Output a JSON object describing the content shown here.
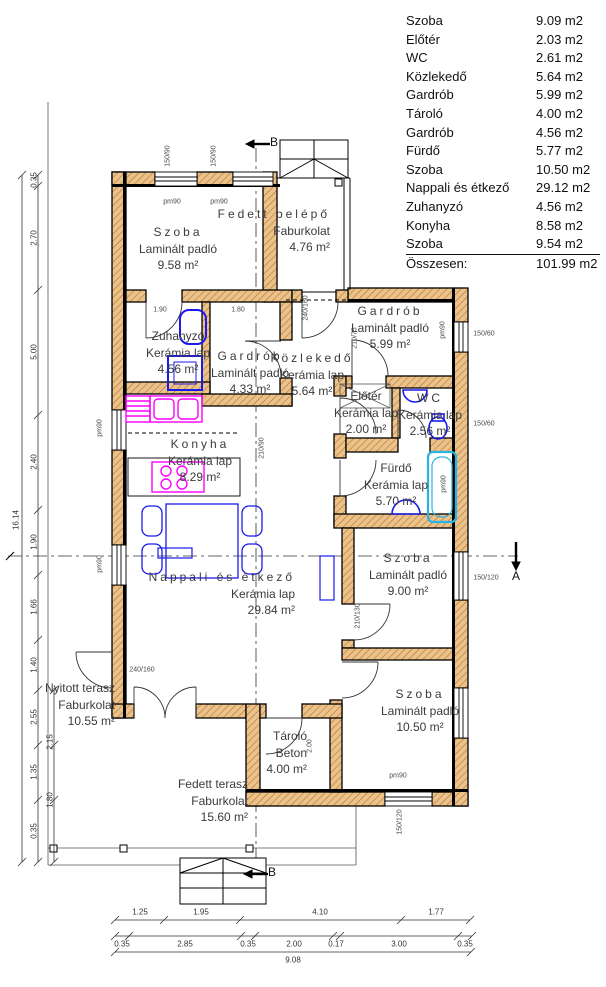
{
  "legend": {
    "rows": [
      {
        "name": "Szoba",
        "area": "9.09 m2"
      },
      {
        "name": "Előtér",
        "area": "2.03 m2"
      },
      {
        "name": "WC",
        "area": "2.61 m2"
      },
      {
        "name": "Közlekedő",
        "area": "5.64 m2"
      },
      {
        "name": "Gardrób",
        "area": "5.99 m2"
      },
      {
        "name": "Tároló",
        "area": "4.00 m2"
      },
      {
        "name": "Gardrób",
        "area": "4.56 m2"
      },
      {
        "name": "Fürdő",
        "area": "5.77 m2"
      },
      {
        "name": "Szoba",
        "area": "10.50 m2"
      },
      {
        "name": "Nappali és étkező",
        "area": "29.12 m2"
      },
      {
        "name": "Zuhanyzó",
        "area": "4.56 m2"
      },
      {
        "name": "Konyha",
        "area": "8.58 m2"
      },
      {
        "name": "Szoba",
        "area": "9.54 m2"
      }
    ],
    "total_label": "Összesen:",
    "total_value": "101.99 m2"
  },
  "rooms": {
    "szoba1": {
      "name": "Szoba",
      "floor": "Laminált padló",
      "area": "9.58 m²"
    },
    "fedett_belepo": {
      "name": "Fedett belépő",
      "floor": "Faburkolat",
      "area": "4.76 m²"
    },
    "zuhanyzo": {
      "name": "Zuhanyzó",
      "floor": "Kerámia lap",
      "area": "4.56 m²"
    },
    "gardrob1": {
      "name": "Gardrób",
      "floor": "Laminált padló",
      "area": "4.33 m²"
    },
    "kozlekedo": {
      "name": "Közlekedő",
      "floor": "Kerámia lap",
      "area": "5.64 m²"
    },
    "gardrob2": {
      "name": "Gardrób",
      "floor": "Laminált padló",
      "area": "5.99 m²"
    },
    "eloter": {
      "name": "Előtér",
      "floor": "Kerámia lap",
      "area": "2.00 m²"
    },
    "wc": {
      "name": "WC",
      "floor": "Kerámia lap",
      "area": "2.56 m²"
    },
    "konyha": {
      "name": "Konyha",
      "floor": "Kerámia lap",
      "area": "8.29 m²"
    },
    "furdo": {
      "name": "Fürdő",
      "floor": "Kerámia lap",
      "area": "5.70 m²"
    },
    "szoba2": {
      "name": "Szoba",
      "floor": "Laminált padló",
      "area": "9.00 m²"
    },
    "nappali": {
      "name": "Nappali és étkező",
      "floor": "Kerámia lap",
      "area": "29.84 m²"
    },
    "szoba3": {
      "name": "Szoba",
      "floor": "Laminált padló",
      "area": "10.50 m²"
    },
    "tarolo": {
      "name": "Tároló",
      "floor": "Beton",
      "area": "4.00 m²"
    },
    "nyitott_terasz": {
      "name": "Nyitott terasz",
      "floor": "Faburkolat",
      "area": "10.55 m²"
    },
    "fedett_terasz": {
      "name": "Fedett terasz",
      "floor": "Faburkolat",
      "area": "15.60 m²"
    }
  },
  "dimensions": {
    "bottom1": [
      "1.25",
      "1.95",
      "4.10",
      "1.77"
    ],
    "bottom2": [
      "0.35",
      "2.85",
      "0.35",
      "2.00",
      "0.17",
      "3.00",
      "0.35"
    ],
    "bottom_total": "9.08",
    "left_total": "16.14",
    "left_chain": [
      "0.35",
      "2.70",
      "5.00",
      "2.40",
      "1.90",
      "1.66",
      "1.40",
      "2.55",
      "1.35",
      "0.35"
    ],
    "left_extra": [
      "2.15",
      "1.80"
    ]
  },
  "annotations": {
    "win_150_90": "150/90",
    "win_150_60": "150/60",
    "win_150_120": "150/120",
    "pm90": "pm90",
    "door_240_160": "240/160",
    "door_210_75": "210/75",
    "door_210_130": "210/130",
    "door_210_90": "210/90",
    "d190": "1.90",
    "d180": "1.80",
    "d200": "2.00"
  },
  "markers": {
    "a": "A",
    "b": "B"
  },
  "colors": {
    "wall_hatch_bg": "#eac28c",
    "wall_hatch_line": "#b96a1e",
    "wall_line": "#000000",
    "fixture_blue": "#1a1aee",
    "fixture_magenta": "#ff00ff",
    "fixture_cyan": "#29b2e3"
  }
}
